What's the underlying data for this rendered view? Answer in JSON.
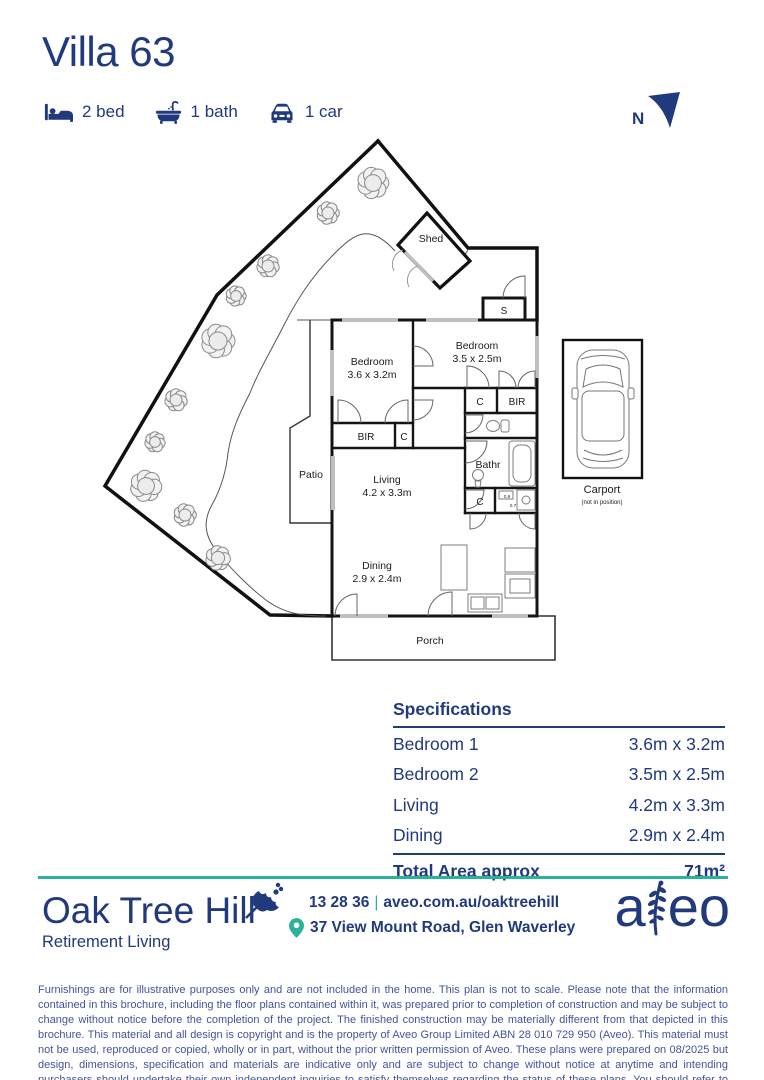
{
  "page": {
    "title": "Villa 63"
  },
  "features": [
    {
      "icon": "bed-icon",
      "label": "2 bed"
    },
    {
      "icon": "bath-icon",
      "label": "1 bath"
    },
    {
      "icon": "car-icon",
      "label": "1 car"
    }
  ],
  "compass": {
    "label": "N"
  },
  "floor_plan": {
    "rooms": {
      "shed": "Shed",
      "storage": "S",
      "bedroom1_name": "Bedroom",
      "bedroom1_dims": "3.6 x 3.2m",
      "bedroom2_name": "Bedroom",
      "bedroom2_dims": "3.5 x 2.5m",
      "bir1": "BIR",
      "closet1": "C",
      "closet2": "C",
      "bir2": "BIR",
      "bathroom": "Bathr",
      "closet3": "C",
      "laundry_dim1": "0.9",
      "laundry_dim2": "0.7",
      "living_name": "Living",
      "living_dims": "4.2 x 3.3m",
      "dining_name": "Dining",
      "dining_dims": "2.9 x 2.4m",
      "patio": "Patio",
      "porch": "Porch",
      "carport": "Carport",
      "carport_note": "(not in position)"
    }
  },
  "specifications": {
    "title": "Specifications",
    "rows": [
      {
        "label": "Bedroom 1",
        "value": "3.6m x 3.2m"
      },
      {
        "label": "Bedroom 2",
        "value": "3.5m x 2.5m"
      },
      {
        "label": "Living",
        "value": "4.2m x 3.3m"
      },
      {
        "label": "Dining",
        "value": "2.9m x 2.4m"
      }
    ],
    "total_label": "Total Area approx",
    "total_value": "71m²"
  },
  "footer": {
    "community_name": "Oak Tree Hill",
    "community_tagline": "Retirement Living",
    "phone": "13 28 36",
    "separator": "|",
    "website": "aveo.com.au/oaktreehill",
    "address": "37 View Mount Road, Glen Waverley",
    "brand": "aveo",
    "brand_a": "a",
    "brand_eo": "eo",
    "disclaimer": "Furnishings are for illustrative purposes only and are not included in the home. This plan is not to scale. Please note that the information contained in this brochure, including the floor plans contained within it, was prepared prior to completion of construction and may be subject to change without notice before the completion of the project. The finished construction may be materially different from that depicted in this brochure. This material and all design is copyright and is the property of Aveo Group Limited ABN 28 010 729 950 (Aveo). This material must not be used, reproduced or copied, wholly or in part, without the prior written permission of Aveo. These plans were prepared on 08/2025 but design, dimensions, specification and materials are indicative only and are subject to change without notice at anytime and intending purchasers should undertake their own independent inquiries to satisfy themselves regarding the status of these plans. You should refer to appropriate Survey Plans for confirmation of individual unit areas."
  },
  "colors": {
    "navy": "#21397d",
    "teal": "#2bb29a"
  }
}
